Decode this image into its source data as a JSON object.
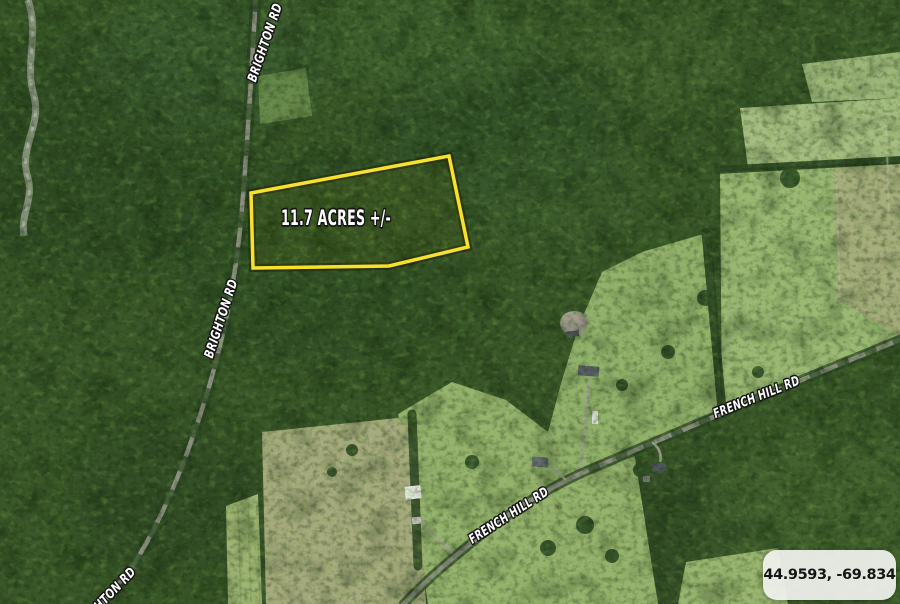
{
  "map": {
    "parcel": {
      "label": "11.7 ACRES +/-",
      "outline_color": "#F8E12C"
    },
    "road_labels": [
      {
        "road": "Brighton Rd",
        "text": "BRIGHTON RD",
        "position": "north"
      },
      {
        "road": "Brighton Rd",
        "text": "BRIGHTON RD",
        "position": "middle"
      },
      {
        "road": "Brighton Rd",
        "text": "BRIGHTON RD",
        "position": "south"
      },
      {
        "road": "French Hill Rd",
        "text": "FRENCH HILL RD",
        "position": "east"
      },
      {
        "road": "French Hill Rd",
        "text": "FRENCH HILL RD",
        "position": "west"
      }
    ],
    "coordinates_badge": {
      "text": "44.9593, -69.834"
    },
    "colors": {
      "forest": "#3A5729",
      "field": "#A6BD81",
      "road": "#8E9082",
      "parcel_outline": "#F8E12C",
      "label_text": "#FFFFFF",
      "label_outline": "#141414",
      "badge_background": "#F1F2EE",
      "badge_text": "#151515"
    }
  }
}
